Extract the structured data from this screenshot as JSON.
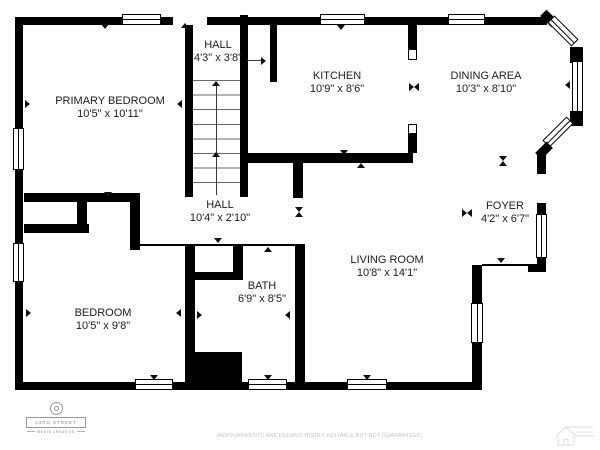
{
  "colors": {
    "background": "#ffffff",
    "wall": "#000000",
    "label_text": "#1c1c1c",
    "branding_gray": "#8a8a8a",
    "disclaimer_gray": "#c2c2c2",
    "watermark_gray": "#dcdcdc"
  },
  "rooms": {
    "upper_hall": {
      "name": "HALL",
      "dims": "4'3\" x 3'8\""
    },
    "kitchen": {
      "name": "KITCHEN",
      "dims": "10'9\" x 8'6\""
    },
    "dining": {
      "name": "DINING AREA",
      "dims": "10'3\" x 8'10\""
    },
    "primary_bedroom": {
      "name": "PRIMARY BEDROOM",
      "dims": "10'5\" x 10'11\""
    },
    "hall": {
      "name": "HALL",
      "dims": "10'4\" x 2'10\""
    },
    "foyer": {
      "name": "FOYER",
      "dims": "4'2\" x 6'7\""
    },
    "living_room": {
      "name": "LIVING ROOM",
      "dims": "10'8\" x 14'1\""
    },
    "bath": {
      "name": "BATH",
      "dims": "6'9\" x 8'5\""
    },
    "bedroom": {
      "name": "BEDROOM",
      "dims": "10'5\" x 9'8\""
    }
  },
  "branding": {
    "logo_icon": "aperture-icon",
    "logo_line1": "23RD STREET",
    "logo_line2": "MEDIA CREATIVE"
  },
  "footer": {
    "disclaimer": "MEASUREMENTS ARE DEEMED HIGHLY RELIABLE BUT NOT GUARANTEED."
  },
  "watermark": {
    "icon": "house-watermark-icon"
  }
}
